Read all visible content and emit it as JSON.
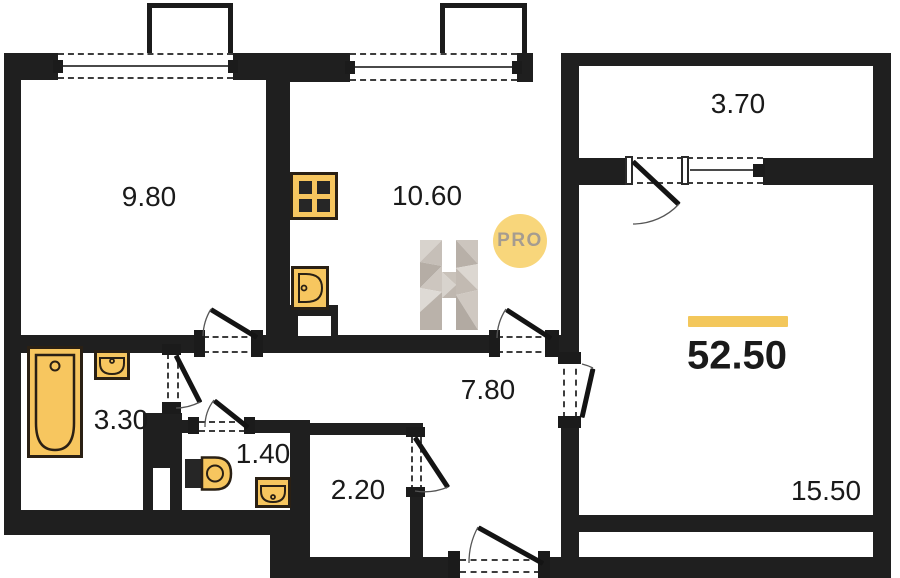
{
  "plan": {
    "total_area": "52.50",
    "badge_text": "PRO",
    "watermark_letter": "H",
    "rooms": [
      {
        "name": "room",
        "area": "9.80"
      },
      {
        "name": "kitchen",
        "area": "10.60"
      },
      {
        "name": "balcony",
        "area": "3.70"
      },
      {
        "name": "bathroom",
        "area": "3.30"
      },
      {
        "name": "wc",
        "area": "1.40"
      },
      {
        "name": "storage",
        "area": "2.20"
      },
      {
        "name": "hallway",
        "area": "7.80"
      },
      {
        "name": "living-room",
        "area": "15.50"
      }
    ],
    "colors": {
      "wall": "#1f1f1f",
      "fixture_fill": "#F7C65F",
      "fixture_stroke": "#2A2014",
      "accent_bar": "#F3C75B",
      "badge_fill": "#F8D67B",
      "badge_text_color": "#A59C90"
    }
  }
}
